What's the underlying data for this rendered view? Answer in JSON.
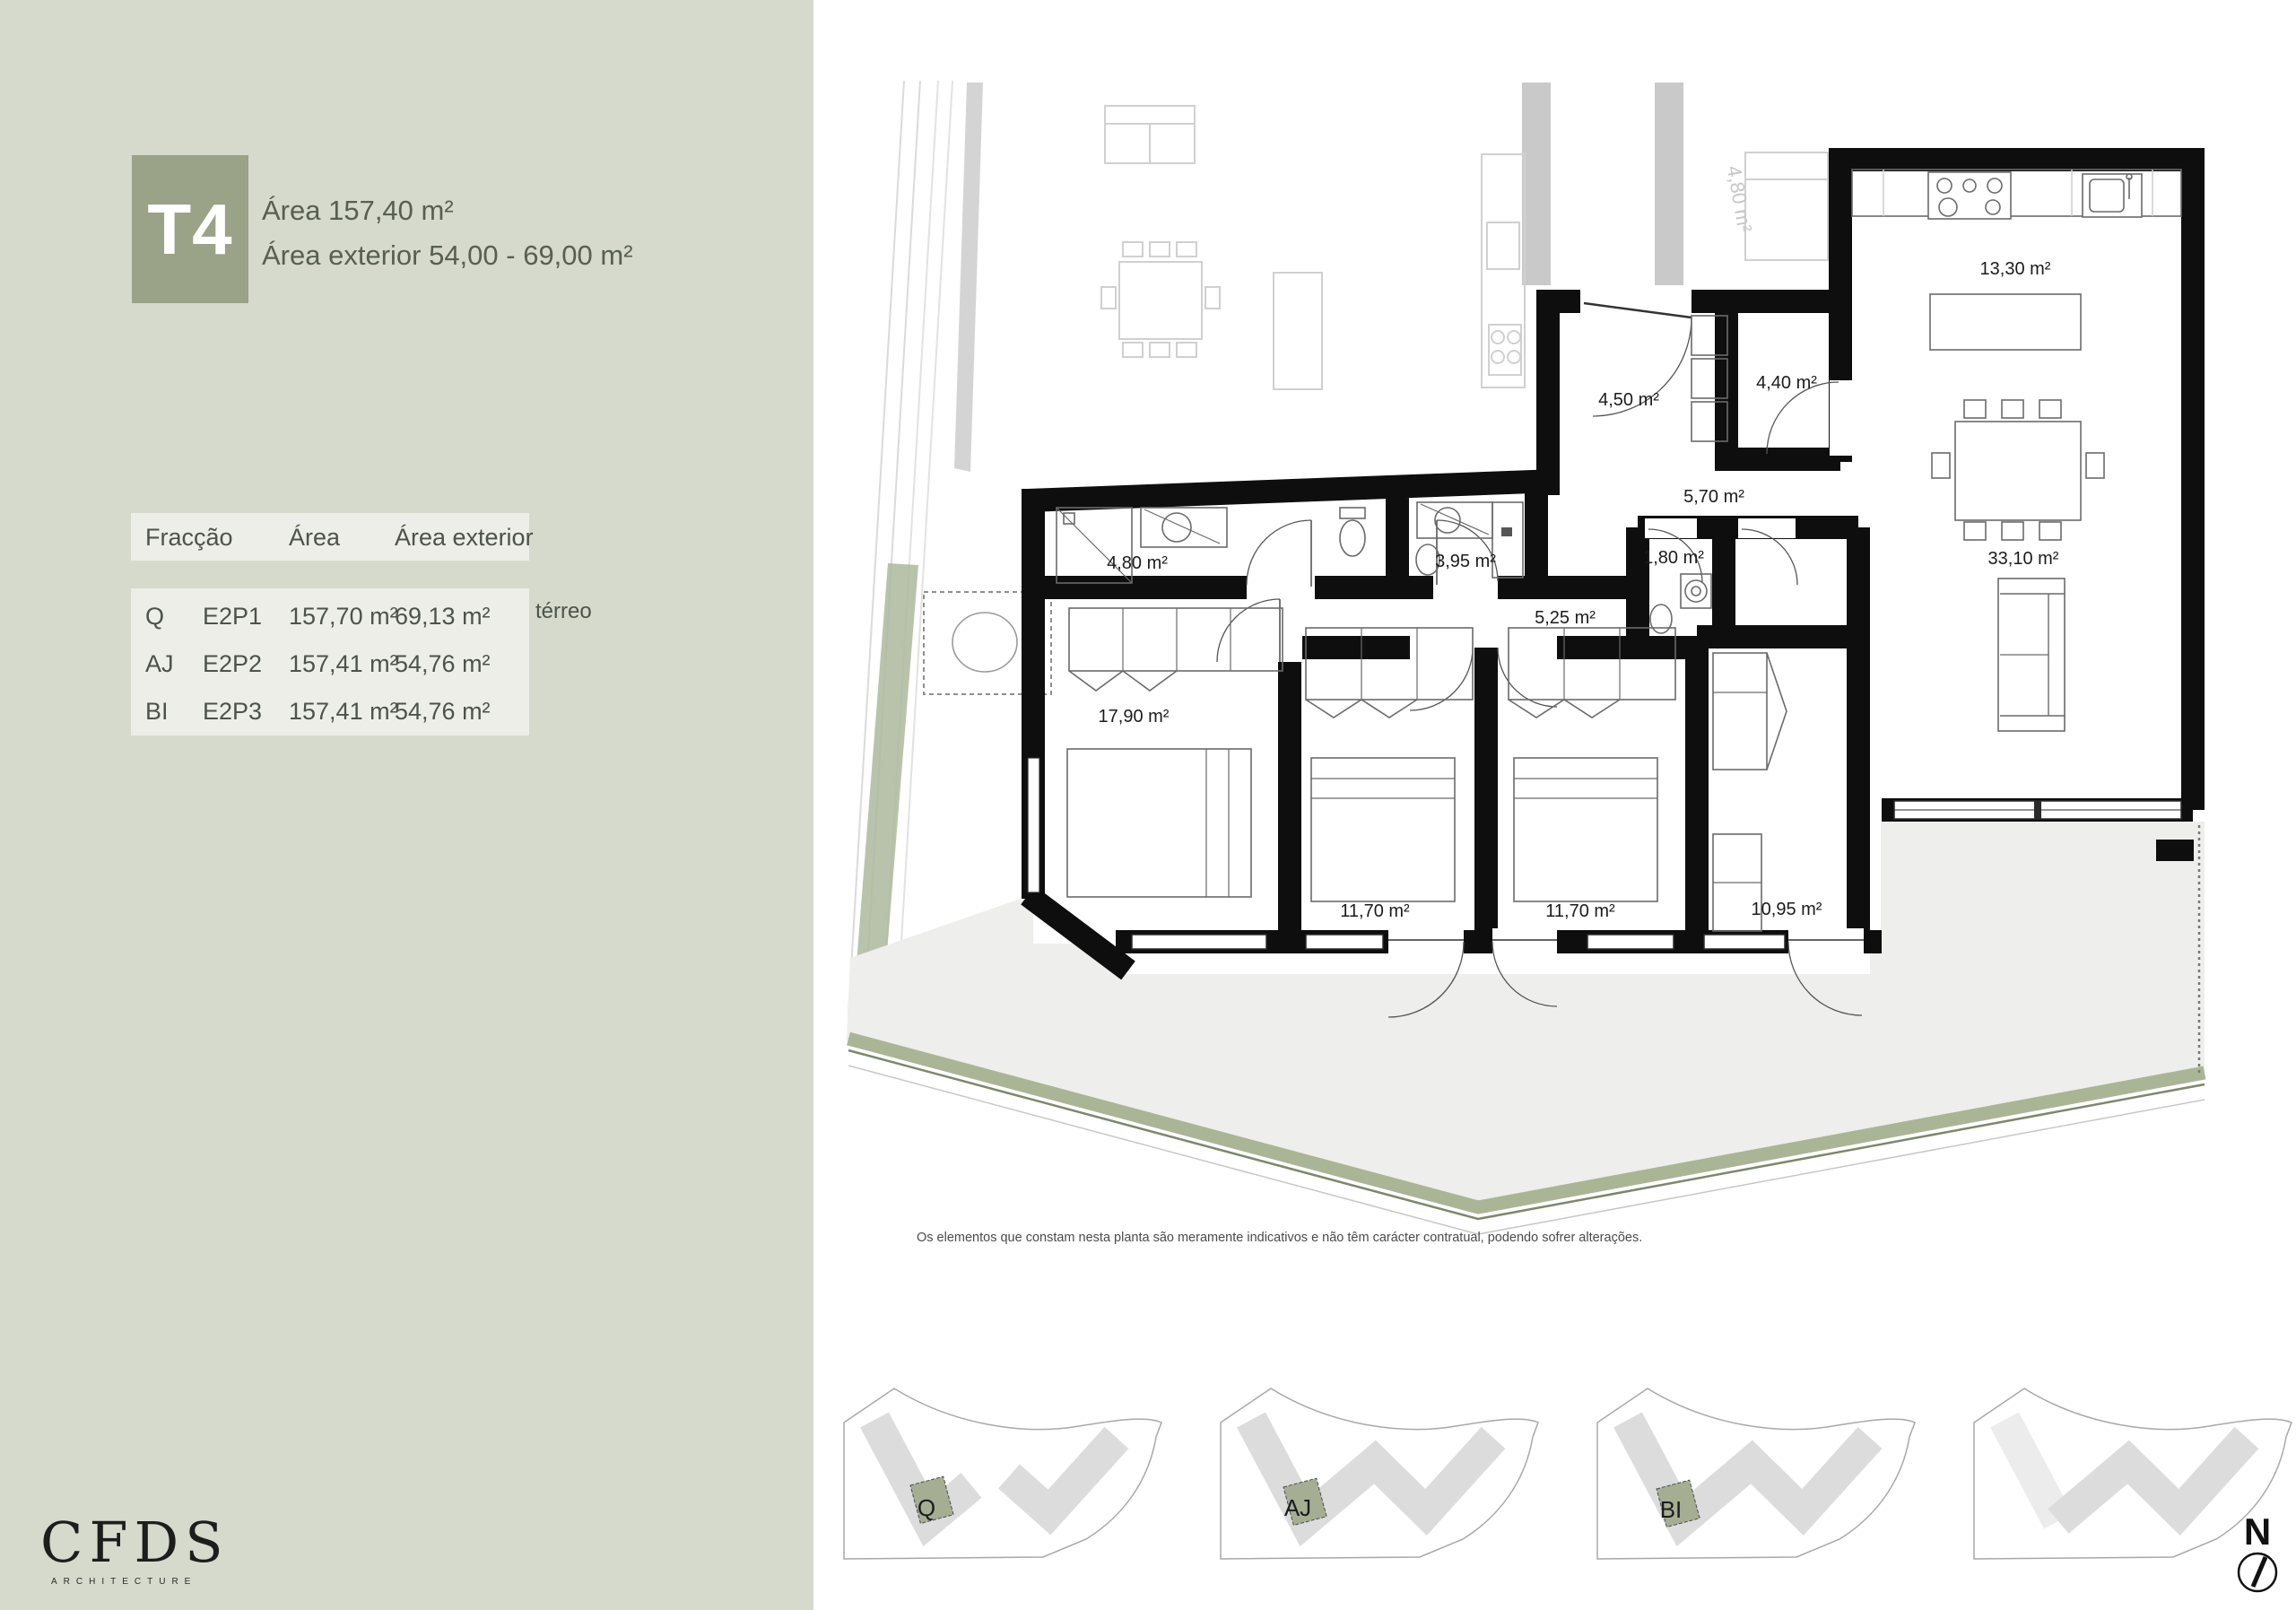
{
  "sidebar": {
    "badge": {
      "label": "T4"
    },
    "title_line1": "Área 157,40 m²",
    "title_line2": "Área exterior 54,00 - 69,00 m²",
    "table": {
      "headers": [
        "Fracção",
        "Área",
        "Área exterior"
      ],
      "rows": [
        {
          "fraccao": "Q",
          "code": "E2P1",
          "area": "157,70 m²",
          "exterior": "69,13 m²",
          "note": "térreo"
        },
        {
          "fraccao": "AJ",
          "code": "E2P2",
          "area": "157,41 m²",
          "exterior": "54,76 m²",
          "note": ""
        },
        {
          "fraccao": "BI",
          "code": "E2P3",
          "area": "157,41 m²",
          "exterior": "54,76 m²",
          "note": ""
        }
      ]
    },
    "logo": {
      "name": "CFDS",
      "sub": "ARCHITECTURE"
    }
  },
  "plan": {
    "disclaimer": "Os elementos que constam nesta planta são meramente indicativos e não têm carácter contratual, podendo sofrer alterações.",
    "north_label": "N",
    "rooms": [
      {
        "id": "kitchen",
        "label": "13,30 m²"
      },
      {
        "id": "entry",
        "label": "4,50 m²"
      },
      {
        "id": "storage",
        "label": "4,40 m²"
      },
      {
        "id": "hall",
        "label": "5,70 m²"
      },
      {
        "id": "bath-1",
        "label": "4,80 m²"
      },
      {
        "id": "bath-2",
        "label": "3,95 m²"
      },
      {
        "id": "wc",
        "label": "1,80 m²"
      },
      {
        "id": "hall-2",
        "label": "5,25 m²"
      },
      {
        "id": "living",
        "label": "33,10 m²"
      },
      {
        "id": "bedroom-1",
        "label": "17,90 m²"
      },
      {
        "id": "bedroom-2",
        "label": "11,70 m²"
      },
      {
        "id": "bedroom-3",
        "label": "11,70 m²"
      },
      {
        "id": "bedroom-4",
        "label": "10,95 m²"
      },
      {
        "id": "neighbor-bath",
        "label": "4,80 m²"
      }
    ]
  },
  "thumbnails": [
    {
      "label": "Q"
    },
    {
      "label": "AJ"
    },
    {
      "label": "BI"
    },
    {
      "label": ""
    }
  ],
  "colors": {
    "sidebar_bg": "#d5dacd",
    "badge_bg": "#9aa287",
    "table_band_bg": "#edeee8",
    "wall": "#0e0e0e",
    "neighbor_gray": "#c9c9c9",
    "terrace": "#eeeeec",
    "green_band": "#aab596",
    "unit_highlight": "#a5ae93"
  }
}
